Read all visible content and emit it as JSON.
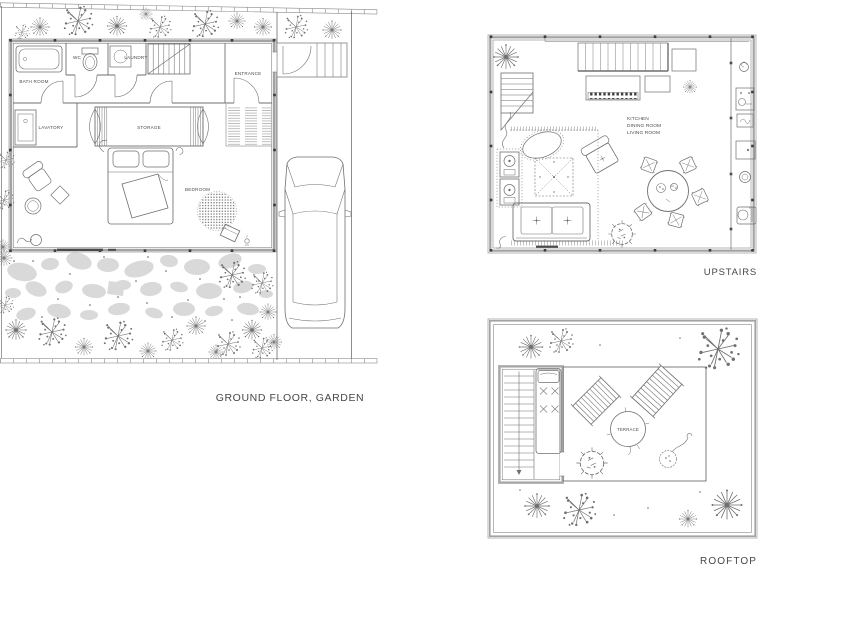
{
  "colors": {
    "background": "#ffffff",
    "line": "#6f6f6f",
    "wall_gray": "#a3a3a3",
    "stone_gray": "#d9d9d9",
    "label_text": "#4c4c4c"
  },
  "ground_floor": {
    "caption": "GROUND FLOOR, GARDEN",
    "rooms": {
      "bath_room": "BATH ROOM",
      "wc": "WC",
      "laundry": "LAUNDRY",
      "entrance": "ENTRANCE",
      "lavatory": "LAVATORY",
      "storage": "STORAGE",
      "bedroom": "BEDROOM"
    }
  },
  "upstairs": {
    "caption": "UPSTAIRS",
    "rooms": {
      "kitchen": "KITCHEN",
      "dining_room": "DINING ROOM",
      "living_room": "LIVING ROOM"
    }
  },
  "rooftop": {
    "caption": "ROOFTOP",
    "labels": {
      "terrace": "TERRACE"
    }
  }
}
